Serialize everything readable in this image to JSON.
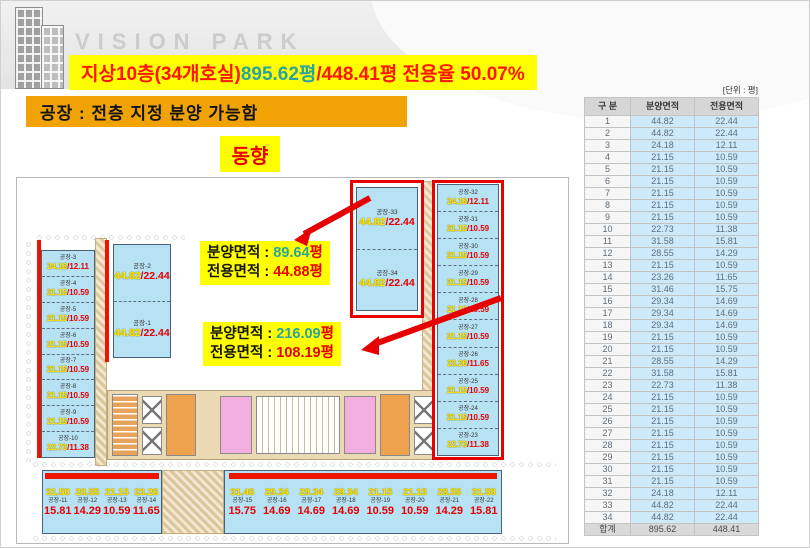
{
  "logo": {
    "text": "VISION PARK"
  },
  "banner": {
    "part_red1": "지상10층(34개호실) ",
    "part_teal": "895.62평",
    "part_red2": "/448.41평 전용율 50.07%"
  },
  "subtitle": "공장 : 전층 지정 분양 가능함",
  "directions": {
    "east": "동향",
    "south": "남향"
  },
  "annotations": [
    {
      "line1_label": "분양면적 : ",
      "line1_value": "89.64",
      "line1_unit": "평",
      "line2_label": "전용면적 : ",
      "line2_value": "44.88",
      "line2_unit": "평"
    },
    {
      "line1_label": "분양면적 : ",
      "line1_value": "216.09",
      "line1_unit": "평",
      "line2_label": "전용면적 : ",
      "line2_value": "108.19",
      "line2_unit": "평"
    }
  ],
  "floor_plan": {
    "left_wing": [
      {
        "name": "공장-3",
        "gross": "24.18",
        "net": "12.11"
      },
      {
        "name": "공장-4",
        "gross": "21.15",
        "net": "10.59"
      },
      {
        "name": "공장-5",
        "gross": "21.15",
        "net": "10.59"
      },
      {
        "name": "공장-6",
        "gross": "21.15",
        "net": "10.59"
      },
      {
        "name": "공장-7",
        "gross": "21.15",
        "net": "10.59"
      },
      {
        "name": "공장-8",
        "gross": "21.15",
        "net": "10.59"
      },
      {
        "name": "공장-9",
        "gross": "21.15",
        "net": "10.59"
      },
      {
        "name": "공장-10",
        "gross": "22.73",
        "net": "11.38"
      }
    ],
    "inner_block": [
      {
        "name": "공장-2",
        "gross": "44.82",
        "net": "22.44"
      },
      {
        "name": "공장-1",
        "gross": "44.82",
        "net": "22.44"
      }
    ],
    "top_block": [
      {
        "name": "공장-33",
        "gross": "44.82",
        "net": "22.44"
      },
      {
        "name": "공장-34",
        "gross": "44.82",
        "net": "22.44"
      }
    ],
    "right_wing": [
      {
        "name": "공장-32",
        "gross": "24.18",
        "net": "12.11"
      },
      {
        "name": "공장-31",
        "gross": "21.15",
        "net": "10.59"
      },
      {
        "name": "공장-30",
        "gross": "21.15",
        "net": "10.59"
      },
      {
        "name": "공장-29",
        "gross": "21.15",
        "net": "10.59"
      },
      {
        "name": "공장-28",
        "gross": "21.15",
        "net": "10.59"
      },
      {
        "name": "공장-27",
        "gross": "21.15",
        "net": "10.59"
      },
      {
        "name": "공장-26",
        "gross": "23.26",
        "net": "11.65"
      },
      {
        "name": "공장-25",
        "gross": "21.15",
        "net": "10.59"
      },
      {
        "name": "공장-24",
        "gross": "21.15",
        "net": "10.59"
      },
      {
        "name": "공장-23",
        "gross": "22.73",
        "net": "11.38"
      }
    ],
    "bottom_left": [
      {
        "name": "공장-11",
        "gross": "31.58",
        "net": "15.81"
      },
      {
        "name": "공장-12",
        "gross": "28.55",
        "net": "14.29"
      },
      {
        "name": "공장-13",
        "gross": "21.15",
        "net": "10.59"
      },
      {
        "name": "공장-14",
        "gross": "23.26",
        "net": "11.65"
      }
    ],
    "bottom_right": [
      {
        "name": "공장-15",
        "gross": "31.46",
        "net": "15.75"
      },
      {
        "name": "공장-16",
        "gross": "29.34",
        "net": "14.69"
      },
      {
        "name": "공장-17",
        "gross": "29.34",
        "net": "14.69"
      },
      {
        "name": "공장-18",
        "gross": "29.34",
        "net": "14.69"
      },
      {
        "name": "공장-19",
        "gross": "21.15",
        "net": "10.59"
      },
      {
        "name": "공장-20",
        "gross": "21.15",
        "net": "10.59"
      },
      {
        "name": "공장-21",
        "gross": "28.55",
        "net": "14.29"
      },
      {
        "name": "공장-22",
        "gross": "31.58",
        "net": "15.81"
      }
    ]
  },
  "table": {
    "unit_note": "[단위 : 평]",
    "headers": [
      "구 분",
      "분양면적",
      "전용면적"
    ],
    "rows": [
      [
        "1",
        "44.82",
        "22.44"
      ],
      [
        "2",
        "44.82",
        "22.44"
      ],
      [
        "3",
        "24.18",
        "12.11"
      ],
      [
        "4",
        "21.15",
        "10.59"
      ],
      [
        "5",
        "21.15",
        "10.59"
      ],
      [
        "6",
        "21.15",
        "10.59"
      ],
      [
        "7",
        "21.15",
        "10.59"
      ],
      [
        "8",
        "21.15",
        "10.59"
      ],
      [
        "9",
        "21.15",
        "10.59"
      ],
      [
        "10",
        "22.73",
        "11.38"
      ],
      [
        "11",
        "31.58",
        "15.81"
      ],
      [
        "12",
        "28.55",
        "14.29"
      ],
      [
        "13",
        "21.15",
        "10.59"
      ],
      [
        "14",
        "23.26",
        "11.65"
      ],
      [
        "15",
        "31.46",
        "15.75"
      ],
      [
        "16",
        "29.34",
        "14.69"
      ],
      [
        "17",
        "29.34",
        "14.69"
      ],
      [
        "18",
        "29.34",
        "14.69"
      ],
      [
        "19",
        "21.15",
        "10.59"
      ],
      [
        "20",
        "21.15",
        "10.59"
      ],
      [
        "21",
        "28.55",
        "14.29"
      ],
      [
        "22",
        "31.58",
        "15.81"
      ],
      [
        "23",
        "22.73",
        "11.38"
      ],
      [
        "24",
        "21.15",
        "10.59"
      ],
      [
        "25",
        "21.15",
        "10.59"
      ],
      [
        "26",
        "21.15",
        "10.59"
      ],
      [
        "27",
        "21.15",
        "10.59"
      ],
      [
        "28",
        "21.15",
        "10.59"
      ],
      [
        "29",
        "21.15",
        "10.59"
      ],
      [
        "30",
        "21.15",
        "10.59"
      ],
      [
        "31",
        "21.15",
        "10.59"
      ],
      [
        "32",
        "24.18",
        "12.11"
      ],
      [
        "33",
        "44.82",
        "22.44"
      ],
      [
        "34",
        "44.82",
        "22.44"
      ]
    ],
    "total": [
      "합계",
      "895.62",
      "448.41"
    ]
  },
  "colors": {
    "accent_red": "#e60000",
    "teal": "#2aa49c",
    "highlight_yellow": "#ffff00",
    "banner_orange": "#f0a303",
    "unit_fill": "#b6e2f4"
  }
}
